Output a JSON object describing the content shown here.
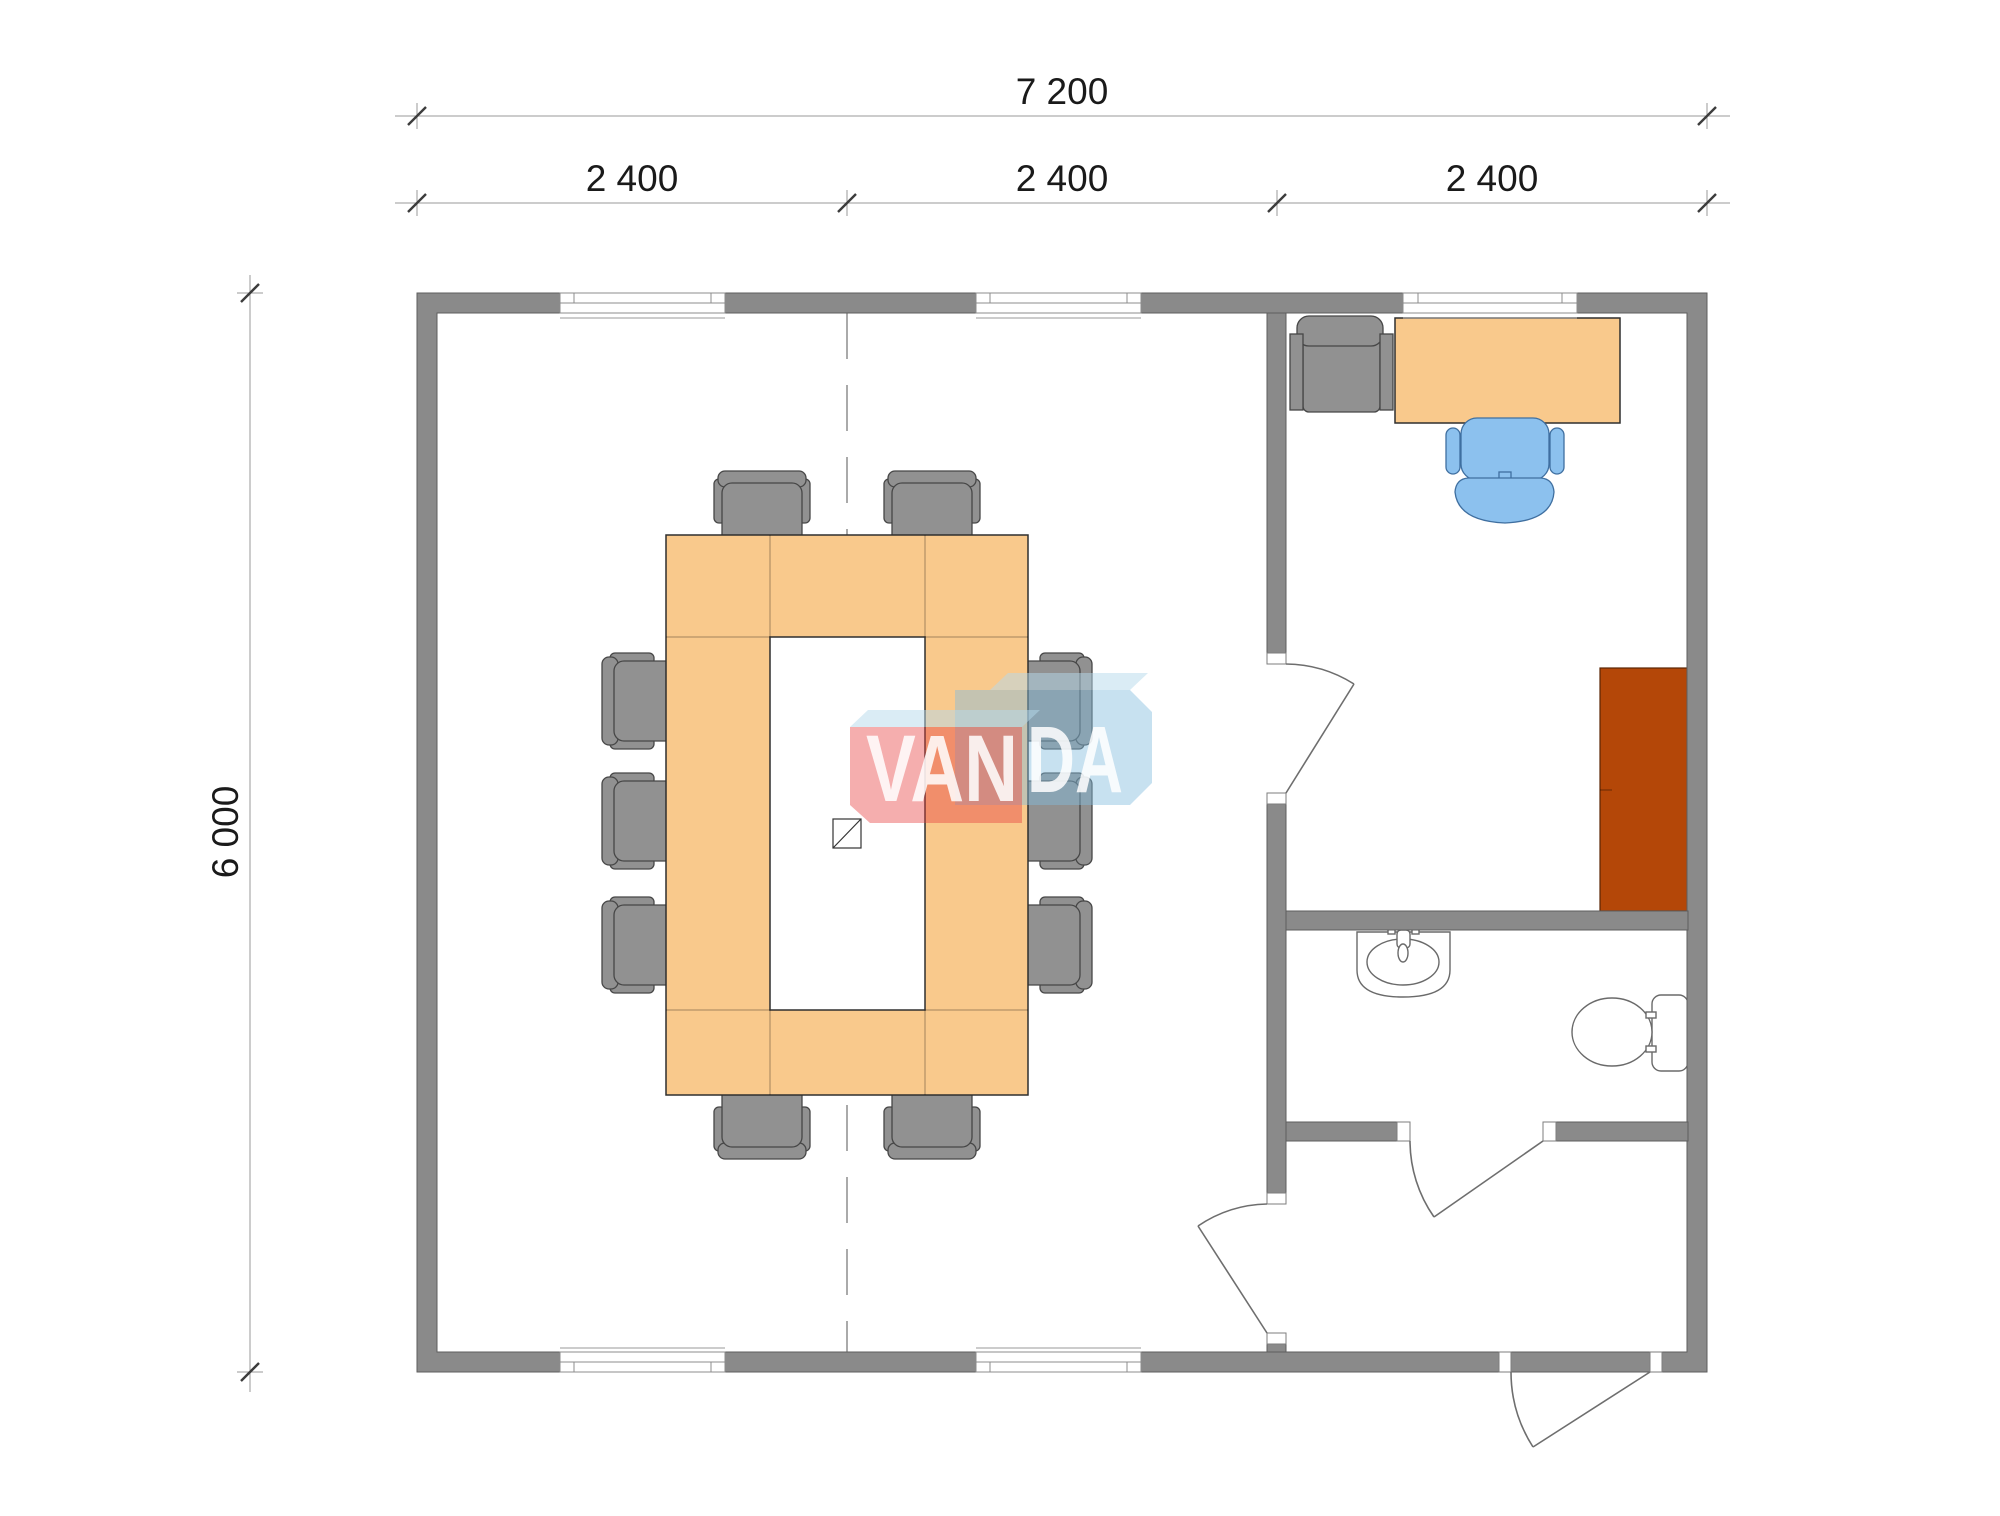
{
  "page": {
    "background": "#ffffff",
    "type": "architectural-floor-plan"
  },
  "dimensions": {
    "top_total_label": "7 200",
    "bay_labels": [
      "2 400",
      "2 400",
      "2 400"
    ],
    "left_height_label": "6 000"
  },
  "watermark": {
    "text": "VANDA",
    "text_left": "VAN",
    "text_right": "DA"
  },
  "colors": {
    "wall": "#8a8a8a",
    "furniture_wood": "#f9c98c",
    "chair_gray": "#919191",
    "office_chair_blue": "#8cc1ee",
    "cabinet_red": "#b44708",
    "fixture_white": "#ffffff",
    "logo_red": "rgba(230,62,62,0.42)",
    "logo_blue": "rgba(130,188,222,0.45)",
    "logo_top_face": "rgba(182,218,236,0.50)",
    "logo_letters": "rgba(255,255,255,0.85)"
  }
}
